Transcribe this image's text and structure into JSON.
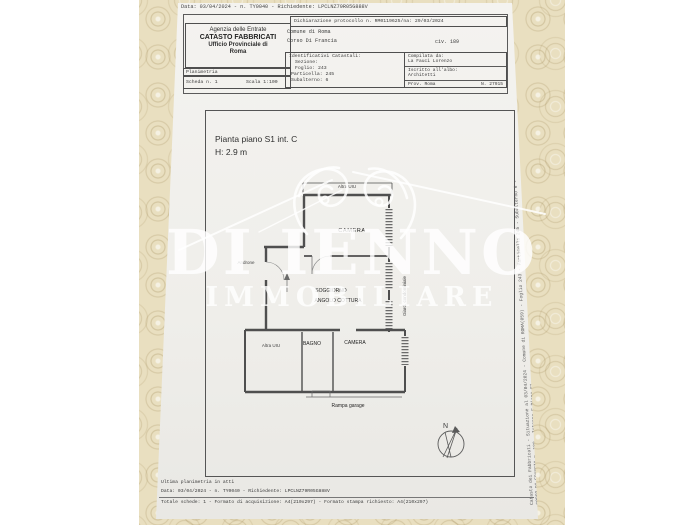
{
  "colors": {
    "wall": "#e9dfc0",
    "paper": "#f2f1ee",
    "ink": "#3a3a3a",
    "plan_line": "#4f4f4f",
    "watermark": "#ffffff"
  },
  "watermark": {
    "brand_top": "DI IENNO",
    "brand_bottom": "IMMOBILIARE"
  },
  "page": {
    "header_line": "Data: 03/04/2024 - n. TY0040 - Richiedente: LPCLNZ79R05G888V",
    "office_box": {
      "l1": "Agenzia delle Entrate",
      "l2": "CATASTO FABBRICATI",
      "l3": "Ufficio Provinciale di",
      "l4": "Roma",
      "doc_type": "Planimetria",
      "sheet": "Scheda n. 1",
      "scale": "Scala 1:100"
    },
    "declaration": {
      "protocol": "Dichiarazione protocollo n. RM0119625/na: 29/03/2024",
      "comune": "Comune di Roma",
      "street": "Corso Di Francia",
      "civic": "civ. 189"
    },
    "cadastral_box": {
      "title": "Identificativi Catastali:",
      "sezione": "Sezione:",
      "foglio": "Foglio: 243",
      "particella": "Particella: 245",
      "subalterno": "Subalterno: 6"
    },
    "compiler_box": {
      "label": "Compilata da:",
      "name": "La Fauci Lorenzo",
      "albo_label": "Iscritto all'albo:",
      "albo": "Architetti",
      "prov": "Prov. Roma",
      "number": "N. 27915"
    },
    "plan": {
      "title": "Pianta piano S1 int. C",
      "height": "H: 2.9 m",
      "labels": {
        "neighbor_top": "Altra UIU",
        "camera_top": "CAMERA",
        "androne": "Androne",
        "soggiorno": "SOGGIORNO",
        "angolo_cottura": "ANGOLO COTTURA",
        "neighbor_bottom": "Altra UIU",
        "bagno": "BAGNO",
        "camera_bottom": "CAMERA",
        "rampa": "Rampa garage",
        "giardino": "Giard. condominiale",
        "north": "N"
      }
    },
    "side_text": {
      "line1": "Catasto dei Fabbricati - Situazione al 03/04/2024 - Comune di ROMA(059) - Foglio 243 - Particella 245 - Subalterno 6 -",
      "line2": "CORSO DI FRANCIA n. 189 - Interno C Piano S1"
    },
    "footer": {
      "line1": "Ultima planimetria in atti",
      "line2": "Data: 03/04/2024 - n. TY0040 - Richiedente: LPCLNZ79R05G888V",
      "line3": "Totale schede: 1 - Formato di acquisizione: A4(210x297) - Formato stampa richiesto: A4(210x297)"
    }
  }
}
